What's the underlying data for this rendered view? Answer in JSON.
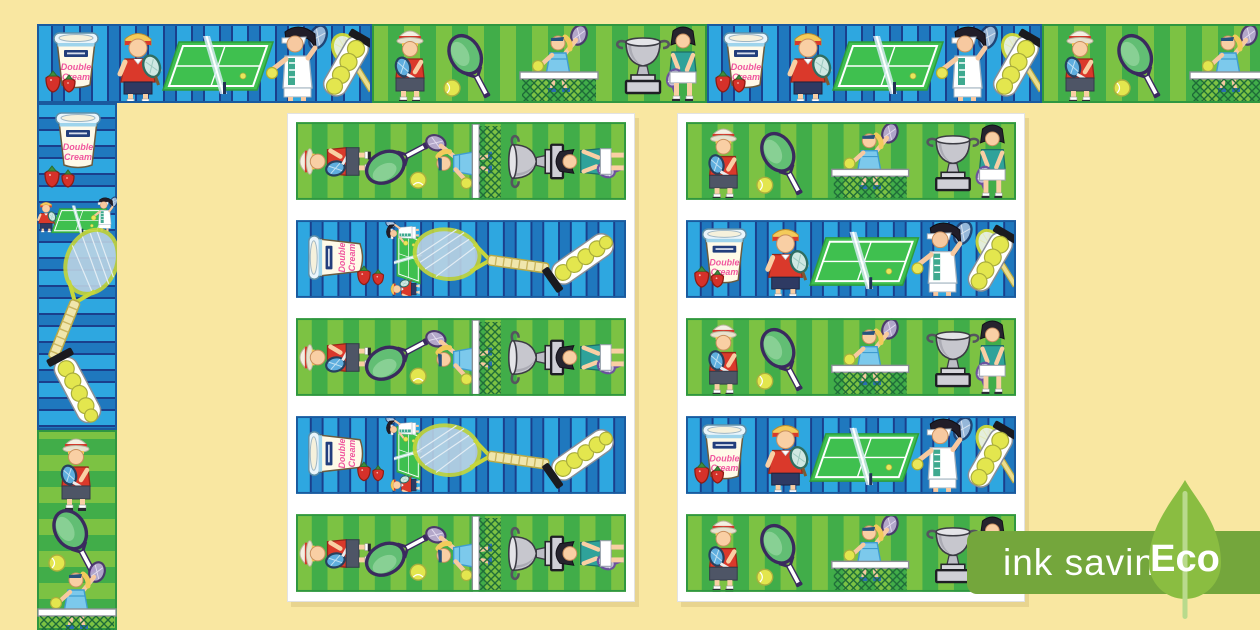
{
  "page": {
    "background_color": "#F9E7A1"
  },
  "badge": {
    "ink_label": "ink saving",
    "eco_label": "Eco",
    "band_color": "#74A63C",
    "leaf_color": "#8ABD41",
    "stem_color": "#B9DA8C",
    "text_color": "#FFFFFF"
  },
  "ice_cream_tub": {
    "line1": "Double",
    "line2": "Cream"
  },
  "colors": {
    "blue_stripe_light": "#2EA7E0",
    "blue_stripe_mid": "#1F78BE",
    "blue_stripe_dark": "#1A3F8C",
    "green_stripe_light": "#7CC243",
    "green_stripe_mid": "#41AD49",
    "court_green": "#3FC04F",
    "ball_yellow": "#E3E64E",
    "shirt_red": "#DA392B",
    "trophy_silver": "#C7C7CE"
  },
  "borders": {
    "top": {
      "segments": [
        "blue",
        "green",
        "blue",
        "green"
      ]
    },
    "left": {
      "segments": [
        "blue",
        "green"
      ]
    }
  },
  "cards": [
    {
      "name": "printable-page-1",
      "strips": [
        "green-rotated",
        "blue-rotated",
        "green-rotated",
        "blue-rotated",
        "green-rotated"
      ]
    },
    {
      "name": "printable-page-2",
      "strips": [
        "green",
        "blue",
        "green",
        "blue",
        "green"
      ]
    }
  ],
  "motifs": {
    "blue_segment": [
      "strawberries",
      "ice-cream-tub",
      "boy-tennis-player",
      "tennis-court-with-net",
      "woman-tennis-player",
      "tennis-ball-tube-and-racket"
    ],
    "green_segment": [
      "boy-in-sun-hat",
      "tennis-racket-and-ball",
      "girl-jumping-net",
      "silver-trophy",
      "girl-tennis-player"
    ]
  }
}
